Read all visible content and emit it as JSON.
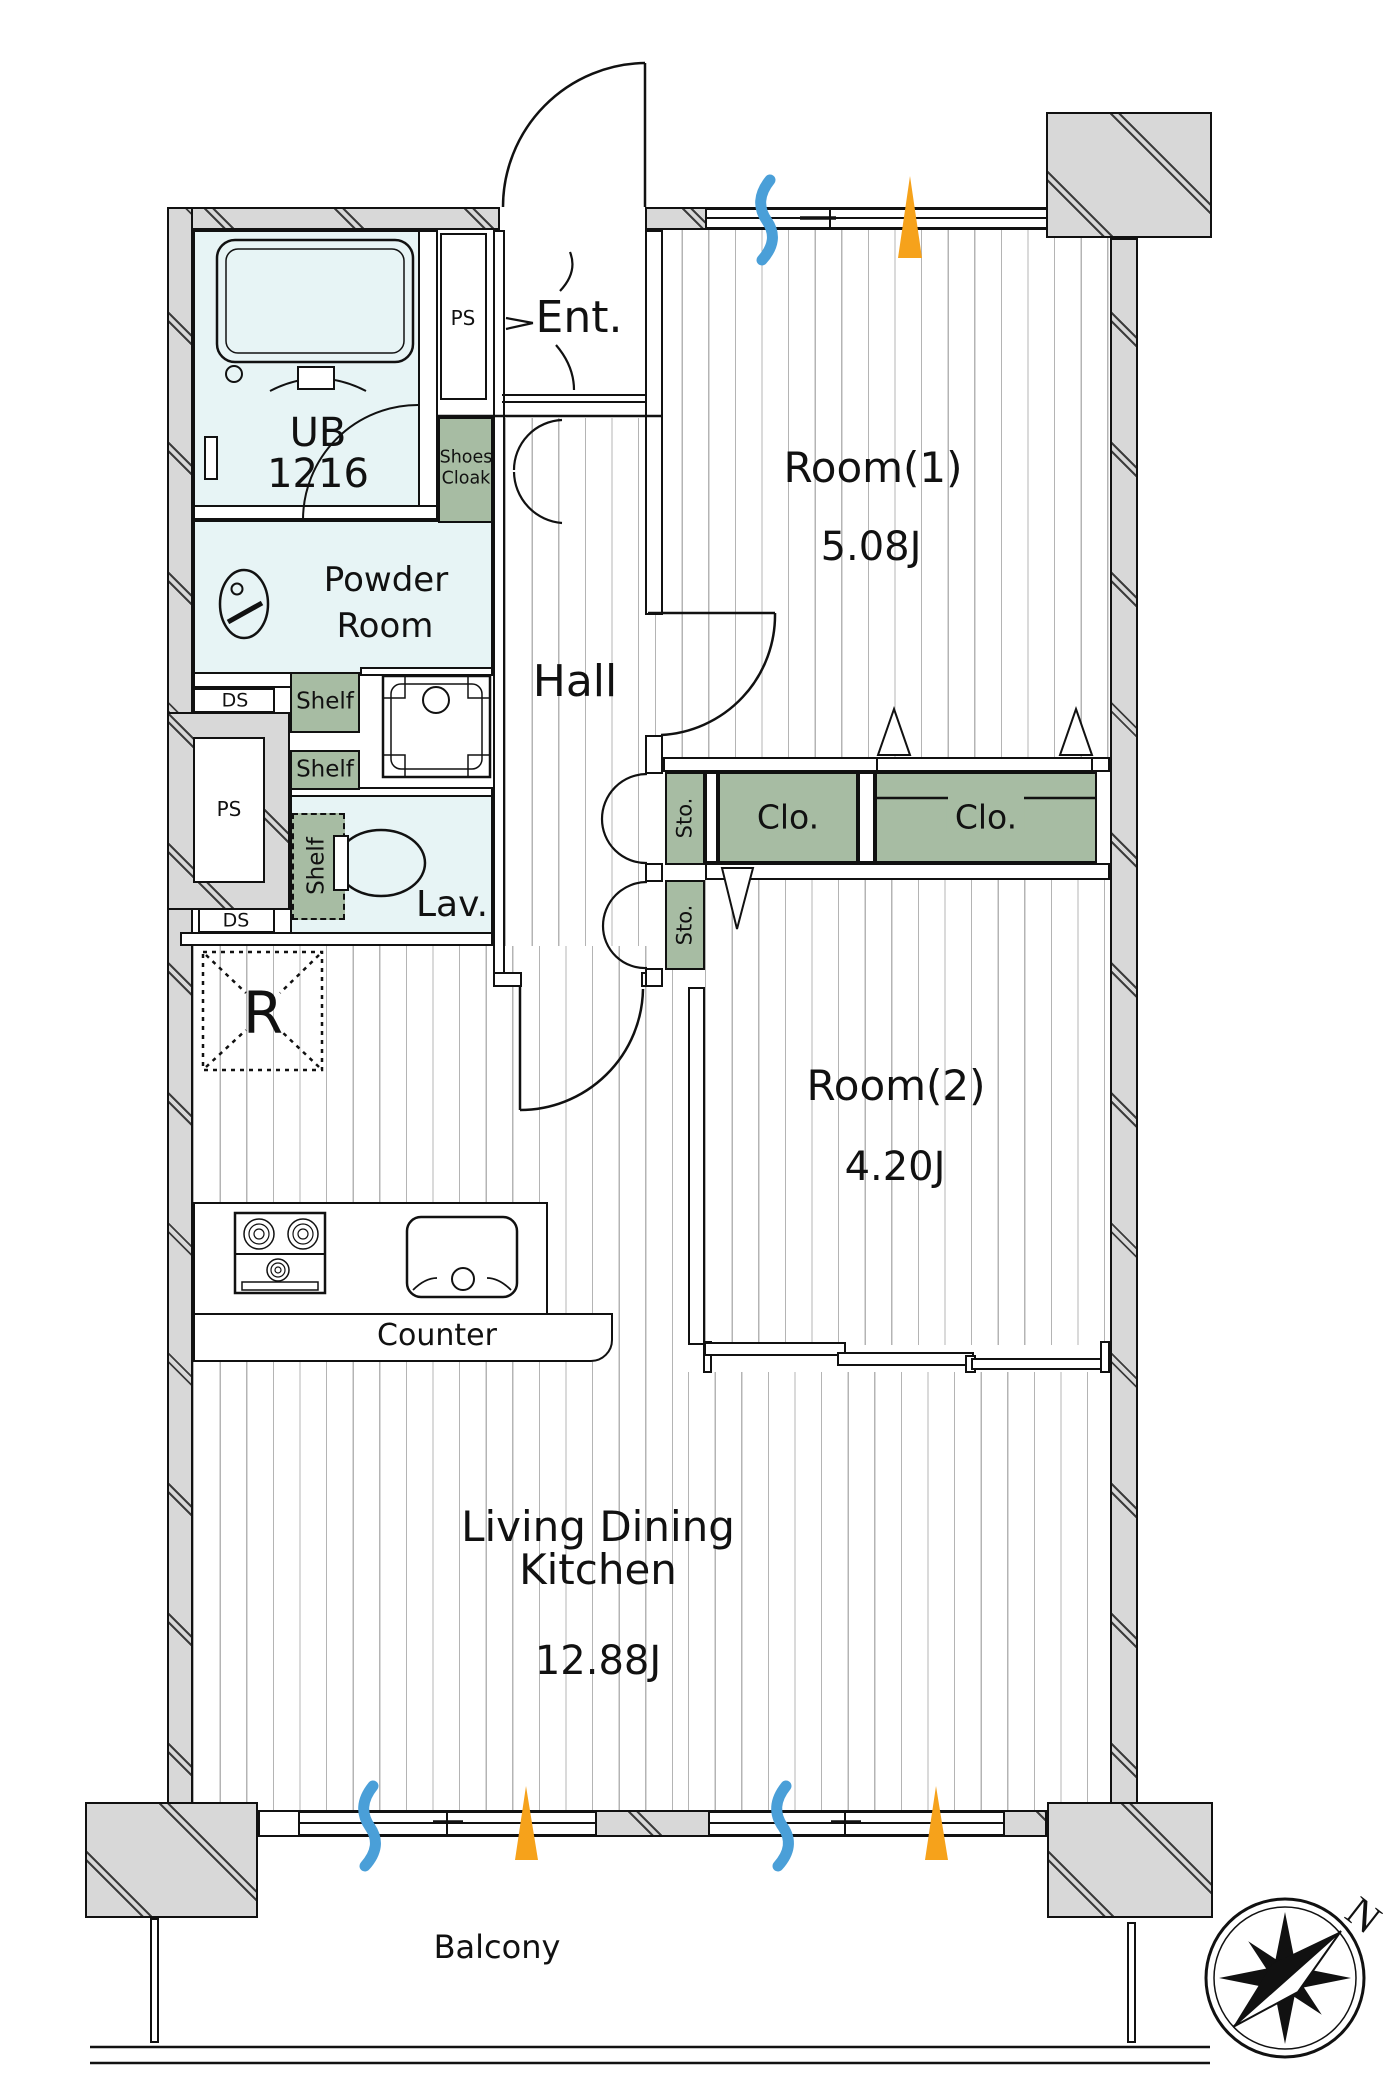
{
  "plan": {
    "rooms": {
      "room1": {
        "label": "Room(1)",
        "size": "5.08J"
      },
      "room2": {
        "label": "Room(2)",
        "size": "4.20J"
      },
      "ldk": {
        "label_line1": "Living Dining",
        "label_line2": "Kitchen",
        "size": "12.88J"
      },
      "hall": {
        "label": "Hall"
      },
      "entrance": {
        "label": "Ent."
      },
      "unit_bath": {
        "label": "UB",
        "size": "1216"
      },
      "powder_room": {
        "label_line1": "Powder",
        "label_line2": "Room"
      },
      "lavatory": {
        "label": "Lav."
      },
      "balcony": {
        "label": "Balcony"
      }
    },
    "fixtures": {
      "shoes_cloak": {
        "label_line1": "Shoes",
        "label_line2": "Cloak"
      },
      "shelf": {
        "label": "Shelf"
      },
      "storage": {
        "label": "Sto."
      },
      "closet": {
        "label": "Clo."
      },
      "pipe_space": {
        "label": "PS"
      },
      "duct_space": {
        "label": "DS"
      },
      "refrigerator": {
        "label": "R"
      },
      "counter": {
        "label": "Counter"
      }
    },
    "compass": {
      "north_label": "N"
    },
    "colors": {
      "wall_gray": "#d8d8d8",
      "closet_green": "#a7bca3",
      "wet_area_cyan": "#e7f4f5",
      "vent_blue": "#4a9fd8",
      "sun_orange": "#f6a21b"
    }
  }
}
